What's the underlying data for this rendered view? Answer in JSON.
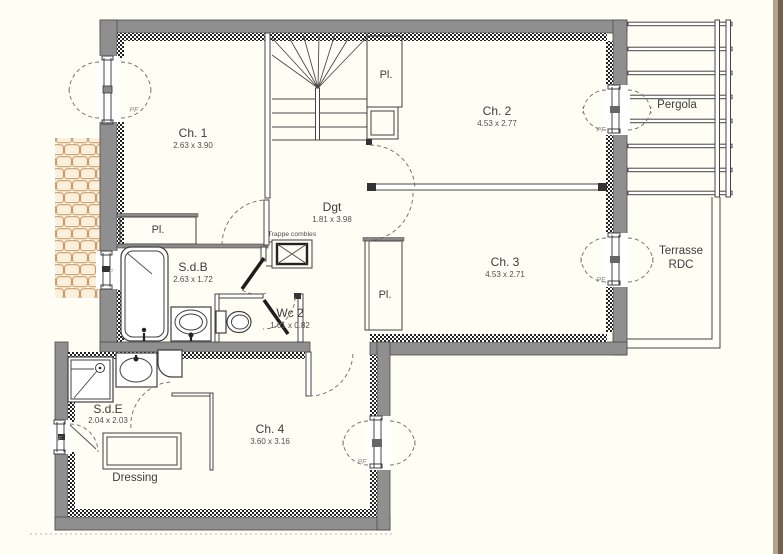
{
  "rooms": [
    {
      "name": "Ch. 1",
      "dims": "2.63 x 3.90"
    },
    {
      "name": "Ch. 2",
      "dims": "4.53 x 2.77"
    },
    {
      "name": "Ch. 3",
      "dims": "4.53 x 2.71"
    },
    {
      "name": "Ch. 4",
      "dims": "3.60 x 3.16"
    },
    {
      "name": "Dgt",
      "dims": "1.81 x 3.98"
    },
    {
      "name": "S.d.B",
      "dims": "2.63 x 1.72"
    },
    {
      "name": "Wc 2",
      "dims": "1.61 x 0.82"
    },
    {
      "name": "S.d.E",
      "dims": "2.04 x 2.03"
    }
  ],
  "outdoor": {
    "pergola": "Pergola",
    "terrasse_line1": "Terrasse",
    "terrasse_line2": "RDC"
  },
  "labels": {
    "dressing": "Dressing",
    "closet": "Pl.",
    "attic_hatch": "Trappe combles",
    "french_window": "PF",
    "window": "F"
  },
  "colors": {
    "wall_gray": "#8f8f8f",
    "line": "#444444",
    "tile_stroke": "#c6935a",
    "edge_stripe_light": "#b5a28c",
    "edge_stripe_dark": "#6f6052",
    "background": "#fffef4"
  }
}
